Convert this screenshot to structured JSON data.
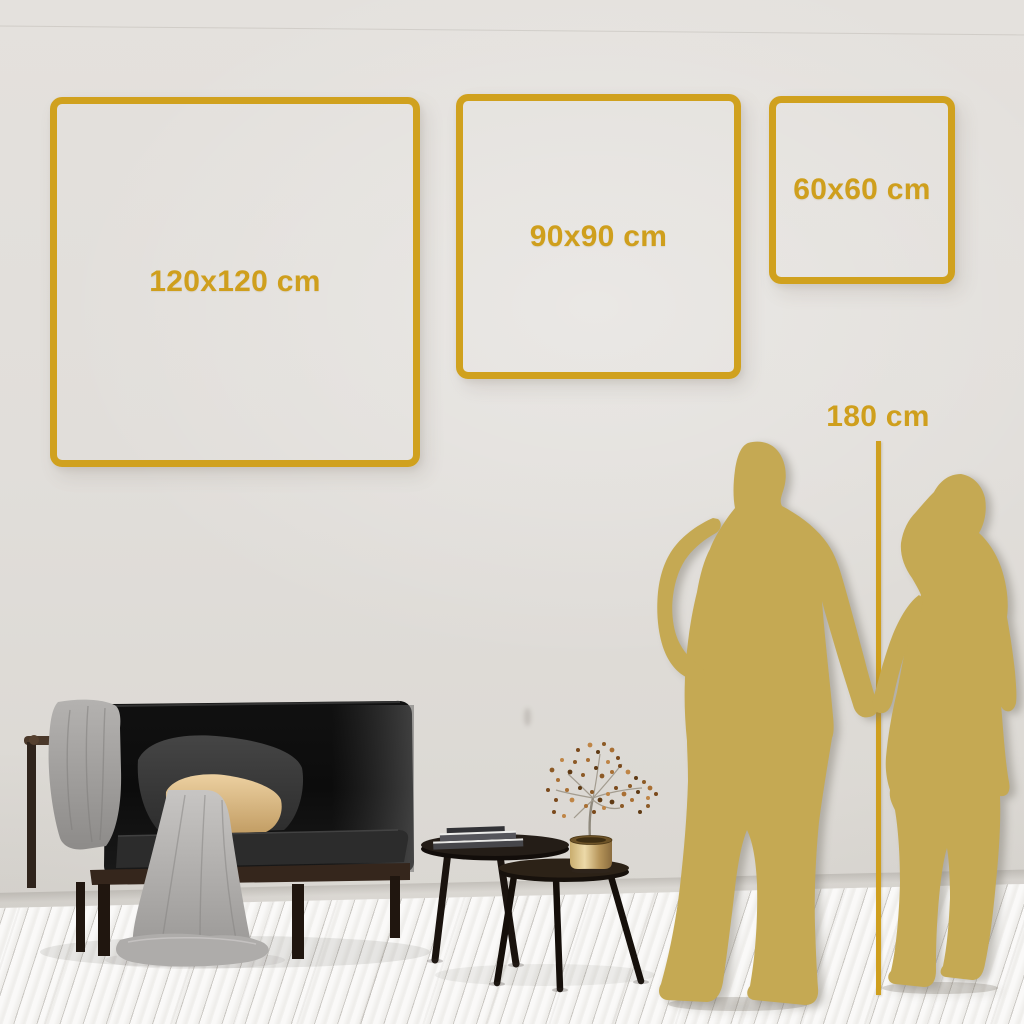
{
  "size_frames": [
    {
      "id": "frame-120",
      "label": "120x120 cm"
    },
    {
      "id": "frame-90",
      "label": "90x90 cm"
    },
    {
      "id": "frame-60",
      "label": "60x60 cm"
    }
  ],
  "height_marker": {
    "label": "180 cm"
  },
  "colors": {
    "accent_gold": "#D0A11E",
    "silhouette_gold": "#C5A953",
    "wall": "#E1DEDA",
    "floor": "#F4F3F1"
  }
}
